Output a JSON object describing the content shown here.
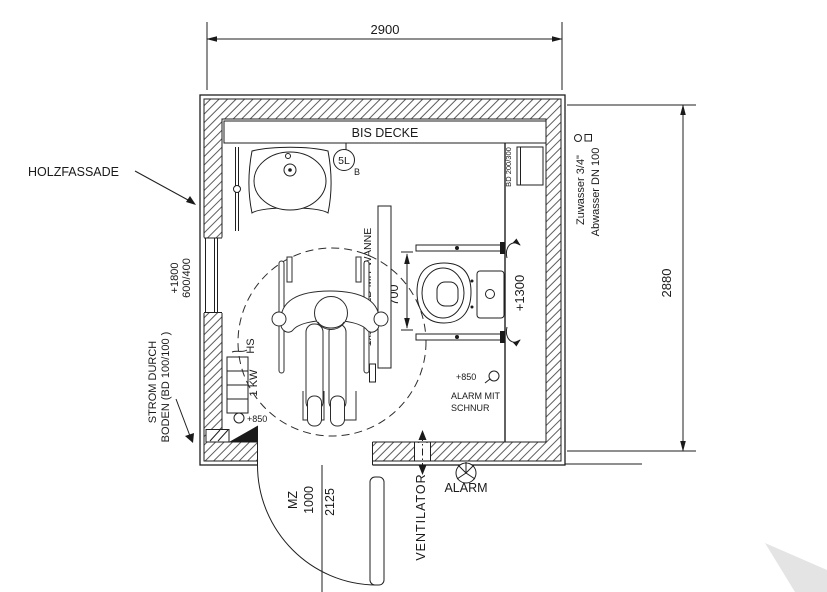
{
  "plan": {
    "dimensions": {
      "overall_width": "2900",
      "overall_height": "2880",
      "wc_clearance": "700"
    },
    "door": {
      "type": "MZ",
      "width": "1000",
      "height": "2125"
    },
    "wall_labels": {
      "facade": "HOLZFASSADE",
      "ceiling_band": "BIS DECKE",
      "floor_power_1": "STROM DURCH",
      "floor_power_2": "BODEN (BD 100/100 )"
    },
    "window": {
      "height_level": "+1800",
      "size": "600/400"
    },
    "heating": {
      "switch": "HS",
      "power": "1 KW",
      "socket_level": "+850"
    },
    "lighting": {
      "led": "1x18W LED MIT WANNE"
    },
    "boiler": {
      "volume": "5L",
      "mark": "B"
    },
    "wc": {
      "cistern_level": "+1300",
      "duct": "BD 200/300"
    },
    "alarm": {
      "level": "+850",
      "line1": "ALARM MIT",
      "line2": "SCHNUR",
      "label": "ALARM"
    },
    "pipes": {
      "supply": "Zuwasser 3/4\"",
      "waste": "Abwasser DN 100"
    },
    "ventilation": {
      "label": "VENTILATOR"
    }
  }
}
